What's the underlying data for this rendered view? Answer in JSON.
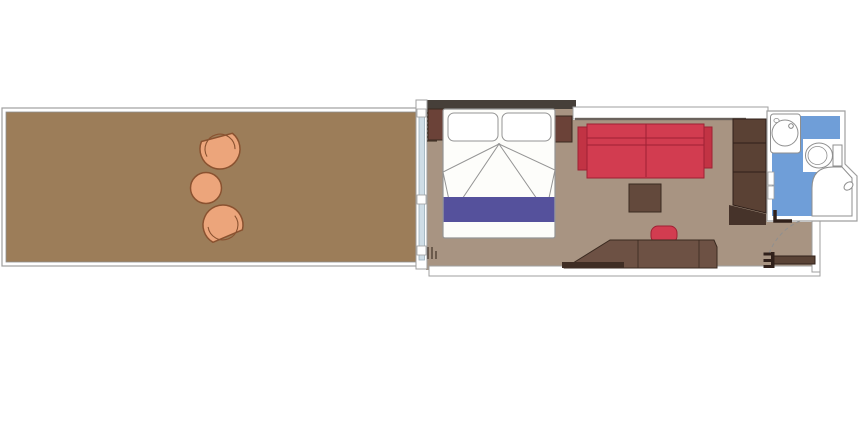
{
  "plan": {
    "kind": "stateroom-floor-plan",
    "rooms": [
      "balcony",
      "bedroom",
      "sitting-area",
      "bathroom",
      "entry-corridor"
    ],
    "palette": {
      "background": "#ffffff",
      "balcony_deck": "#9c7d59",
      "cabin_floor": "#a89482",
      "wall_dark": "#463f39",
      "wall_stroke": "#9f9f9f",
      "glass": "#cfdde6",
      "chair_tan": "#eca57b",
      "chair_stroke": "#8a5230",
      "wood_dark": "#5a4134",
      "wood_mid": "#6d5144",
      "wood_stroke": "#30201a",
      "sofa_red": "#d23c50",
      "sofa_red_dark": "#9e2133",
      "bed_runner_purple": "#55519c",
      "bathroom_blue": "#6f9ed8",
      "fixture_white": "#ffffff",
      "fixture_stroke": "#8f8f8f"
    },
    "viewbox": "0 0 866 426",
    "elements": [
      {
        "name": "balcony-frame",
        "type": "rect",
        "attrs": {
          "x": 2,
          "y": 108,
          "width": 423,
          "height": 158,
          "fill": "#ffffff",
          "stroke": "#9f9f9f",
          "stroke-width": 1.2
        }
      },
      {
        "name": "balcony-deck",
        "type": "rect",
        "attrs": {
          "x": 6,
          "y": 112,
          "width": 415,
          "height": 150,
          "fill": "#9c7d59",
          "stroke": "#8f8f8f",
          "stroke-width": 0.8
        }
      },
      {
        "name": "lounge-chair-top-body",
        "type": "path",
        "attrs": {
          "d": "M -16 -12 A 20 20 0 1 0 16 -12 Z",
          "transform": "translate(220,149) rotate(-15)",
          "fill": "#eca57b",
          "stroke": "#8a5230",
          "stroke-width": 1.5
        }
      },
      {
        "name": "lounge-chair-top-rim",
        "type": "path",
        "attrs": {
          "d": "M -14.5 4 A 15 15 0 1 1 14.5 4",
          "transform": "translate(220,149) rotate(-15)",
          "fill": "none",
          "stroke": "#8a5230",
          "stroke-width": 1.1
        }
      },
      {
        "name": "lounge-chair-bottom-body",
        "type": "path",
        "attrs": {
          "d": "M -16 -12 A 20 20 0 1 0 16 -12 Z",
          "transform": "translate(223,225) rotate(157)",
          "fill": "#eca57b",
          "stroke": "#8a5230",
          "stroke-width": 1.5
        }
      },
      {
        "name": "lounge-chair-bottom-rim",
        "type": "path",
        "attrs": {
          "d": "M -14.5 4 A 15 15 0 1 1 14.5 4",
          "transform": "translate(223,225) rotate(157)",
          "fill": "none",
          "stroke": "#8a5230",
          "stroke-width": 1.1
        }
      },
      {
        "name": "balcony-table",
        "type": "circle",
        "attrs": {
          "cx": 206,
          "cy": 188,
          "r": 15.5,
          "fill": "#eca57b",
          "stroke": "#8a5230",
          "stroke-width": 1.5
        }
      },
      {
        "name": "cabin-floor",
        "type": "polygon",
        "attrs": {
          "points": "426,105 573,105 573,120 767,120 767,222 812,222 812,270 426,270",
          "fill": "#a89482"
        }
      },
      {
        "name": "bottom-wall",
        "type": "rect",
        "attrs": {
          "x": 429,
          "y": 266,
          "width": 391,
          "height": 10,
          "fill": "#ffffff",
          "stroke": "#9f9f9f",
          "stroke-width": 1
        }
      },
      {
        "name": "corridor-right-wall",
        "type": "rect",
        "attrs": {
          "x": 812,
          "y": 220,
          "width": 8,
          "height": 52,
          "fill": "#ffffff",
          "stroke": "#9f9f9f",
          "stroke-width": 1
        }
      },
      {
        "name": "bedroom-top-wall",
        "type": "rect",
        "attrs": {
          "x": 416,
          "y": 100,
          "width": 160,
          "height": 9,
          "fill": "#463f39"
        }
      },
      {
        "name": "sitting-area-top-wall",
        "type": "rect",
        "attrs": {
          "x": 573,
          "y": 107,
          "width": 195,
          "height": 12,
          "fill": "#ffffff",
          "stroke": "#9f9f9f",
          "stroke-width": 1
        }
      },
      {
        "name": "sitting-area-top-wall-line",
        "type": "rect",
        "attrs": {
          "x": 575,
          "y": 117.8,
          "width": 171,
          "height": 2.4,
          "fill": "#6a625c"
        }
      },
      {
        "name": "window-wall",
        "type": "rect",
        "attrs": {
          "x": 416,
          "y": 100,
          "width": 11,
          "height": 169,
          "fill": "#ffffff",
          "stroke": "#9f9f9f",
          "stroke-width": 1
        }
      },
      {
        "name": "window-glass",
        "type": "rect",
        "attrs": {
          "x": 419,
          "y": 112,
          "width": 5.5,
          "height": 148,
          "fill": "#cfdde6",
          "stroke": "#9cb0bc",
          "stroke-width": 0.8
        }
      },
      {
        "name": "window-mullion-top",
        "type": "rect",
        "attrs": {
          "x": 417,
          "y": 109,
          "width": 9,
          "height": 8,
          "fill": "#ffffff",
          "stroke": "#9f9f9f",
          "stroke-width": 0.8
        }
      },
      {
        "name": "window-mullion-middle",
        "type": "rect",
        "attrs": {
          "x": 417,
          "y": 195,
          "width": 9,
          "height": 9,
          "fill": "#ffffff",
          "stroke": "#9f9f9f",
          "stroke-width": 0.8
        }
      },
      {
        "name": "window-mullion-bottom",
        "type": "rect",
        "attrs": {
          "x": 417,
          "y": 246,
          "width": 9,
          "height": 9,
          "fill": "#ffffff",
          "stroke": "#9f9f9f",
          "stroke-width": 0.8
        }
      },
      {
        "name": "curtain-top-hatch",
        "type": "path",
        "attrs": {
          "d": "M427,113 h10 M427,117 h10 M427,121 h10 M427,125 h10 M427,129 h10 M427,133 h10 M427,137 h10 M427,141 h10",
          "fill": "none",
          "stroke": "#4a3a2e",
          "stroke-width": 1.3
        }
      },
      {
        "name": "curtain-bottom-hatch",
        "type": "path",
        "attrs": {
          "d": "M428,247 v12 M432,247 v12 M436,251 v8",
          "fill": "none",
          "stroke": "#4a3a2e",
          "stroke-width": 1.3
        }
      },
      {
        "name": "nightstand-left",
        "type": "rect",
        "attrs": {
          "x": 428,
          "y": 109,
          "width": 22,
          "height": 31,
          "fill": "#6b4238",
          "stroke": "#3a2a20",
          "stroke-width": 1
        }
      },
      {
        "name": "nightstand-right",
        "type": "rect",
        "attrs": {
          "x": 553,
          "y": 116,
          "width": 19,
          "height": 26,
          "fill": "#6b4238",
          "stroke": "#3a2a20",
          "stroke-width": 1
        }
      },
      {
        "name": "bed",
        "type": "rect",
        "attrs": {
          "x": 443,
          "y": 109,
          "width": 112,
          "height": 129,
          "rx": 2,
          "fill": "#fdfdfa",
          "stroke": "#949494",
          "stroke-width": 1.2
        }
      },
      {
        "name": "pillow-left",
        "type": "rect",
        "attrs": {
          "x": 448,
          "y": 113,
          "width": 50,
          "height": 28,
          "rx": 6,
          "fill": "#ffffff",
          "stroke": "#949494",
          "stroke-width": 1
        }
      },
      {
        "name": "pillow-right",
        "type": "rect",
        "attrs": {
          "x": 502,
          "y": 113,
          "width": 49,
          "height": 28,
          "rx": 6,
          "fill": "#ffffff",
          "stroke": "#949494",
          "stroke-width": 1
        }
      },
      {
        "name": "duvet-fold-left",
        "type": "polygon",
        "attrs": {
          "points": "499,144 443,172 452,214",
          "fill": "#fdfdfa",
          "stroke": "#949494",
          "stroke-width": 1
        }
      },
      {
        "name": "duvet-fold-right",
        "type": "polygon",
        "attrs": {
          "points": "499,144 555,170 546,212",
          "fill": "#fdfdfa",
          "stroke": "#949494",
          "stroke-width": 1
        }
      },
      {
        "name": "bed-runner",
        "type": "rect",
        "attrs": {
          "x": 443.6,
          "y": 197,
          "width": 110.8,
          "height": 25,
          "fill": "#55519c"
        }
      },
      {
        "name": "sofa-armrest-left",
        "type": "rect",
        "attrs": {
          "x": 578,
          "y": 127,
          "width": 11,
          "height": 43,
          "fill": "#c23344",
          "stroke": "#9e2133",
          "stroke-width": 1
        }
      },
      {
        "name": "sofa-armrest-right",
        "type": "rect",
        "attrs": {
          "x": 703,
          "y": 127,
          "width": 9,
          "height": 41,
          "fill": "#c23344",
          "stroke": "#9e2133",
          "stroke-width": 1
        }
      },
      {
        "name": "sofa-body",
        "type": "rect",
        "attrs": {
          "x": 587,
          "y": 124,
          "width": 117,
          "height": 54,
          "fill": "#d23c50",
          "stroke": "#9e2133",
          "stroke-width": 1
        }
      },
      {
        "name": "sofa-back-line-1",
        "type": "line",
        "attrs": {
          "x1": 587,
          "y1": 138,
          "x2": 704,
          "y2": 138,
          "stroke": "#9e2133",
          "stroke-width": 1
        }
      },
      {
        "name": "sofa-back-line-2",
        "type": "line",
        "attrs": {
          "x1": 587,
          "y1": 145,
          "x2": 704,
          "y2": 145,
          "stroke": "#9e2133",
          "stroke-width": 1
        }
      },
      {
        "name": "sofa-cushion-divider",
        "type": "line",
        "attrs": {
          "x1": 646,
          "y1": 124,
          "x2": 646,
          "y2": 177,
          "stroke": "#9e2133",
          "stroke-width": 1
        }
      },
      {
        "name": "coffee-table",
        "type": "rect",
        "attrs": {
          "x": 629,
          "y": 184,
          "width": 32,
          "height": 28,
          "fill": "#63493c",
          "stroke": "#3a2a20",
          "stroke-width": 1
        }
      },
      {
        "name": "desk-stool",
        "type": "rect",
        "attrs": {
          "x": 651,
          "y": 226,
          "width": 26,
          "height": 17,
          "rx": 7,
          "fill": "#d23c50",
          "stroke": "#9e2133",
          "stroke-width": 1
        }
      },
      {
        "name": "desk",
        "type": "polygon",
        "attrs": {
          "points": "565,268 610,240 714,240 717,247 717,268",
          "fill": "#6d5144",
          "stroke": "#3a2a20",
          "stroke-width": 1
        }
      },
      {
        "name": "desk-divider-1",
        "type": "line",
        "attrs": {
          "x1": 638,
          "y1": 240,
          "x2": 638,
          "y2": 268,
          "stroke": "#3a2a20",
          "stroke-width": 0.8
        }
      },
      {
        "name": "desk-divider-2",
        "type": "line",
        "attrs": {
          "x1": 699,
          "y1": 240,
          "x2": 699,
          "y2": 268,
          "stroke": "#3a2a20",
          "stroke-width": 0.8
        }
      },
      {
        "name": "desk-ledge",
        "type": "rect",
        "attrs": {
          "x": 562,
          "y": 262,
          "width": 62,
          "height": 6,
          "fill": "#3f2d24"
        }
      },
      {
        "name": "wardrobe",
        "type": "polygon",
        "attrs": {
          "points": "733,119 766,119 766,213 733,205",
          "fill": "#5a4134",
          "stroke": "#30201a",
          "stroke-width": 1
        }
      },
      {
        "name": "wardrobe-divider-1",
        "type": "line",
        "attrs": {
          "x1": 733,
          "y1": 143,
          "x2": 766,
          "y2": 143,
          "stroke": "#30201a",
          "stroke-width": 1
        }
      },
      {
        "name": "wardrobe-divider-2",
        "type": "line",
        "attrs": {
          "x1": 733,
          "y1": 172,
          "x2": 766,
          "y2": 172,
          "stroke": "#30201a",
          "stroke-width": 1
        }
      },
      {
        "name": "wardrobe-base-wedge",
        "type": "polygon",
        "attrs": {
          "points": "729,205 766,214 766,225 729,225",
          "fill": "#46332a"
        }
      },
      {
        "name": "bathroom-walls",
        "type": "path",
        "attrs": {
          "d": "M767,111 H845 V164 L857,176 V221 H767 Z",
          "fill": "#ffffff",
          "stroke": "#9f9f9f",
          "stroke-width": 1.2
        }
      },
      {
        "name": "bathroom-floor",
        "type": "polygon",
        "attrs": {
          "points": "772,116 840,116 840,166 852,178 852,216 772,216",
          "fill": "#6f9ed8"
        }
      },
      {
        "name": "sink-counter",
        "type": "rect",
        "attrs": {
          "x": 770.5,
          "y": 114,
          "width": 30,
          "height": 39,
          "rx": 3,
          "fill": "#ffffff",
          "stroke": "#8f8f8f",
          "stroke-width": 1
        }
      },
      {
        "name": "sink-basin",
        "type": "circle",
        "attrs": {
          "cx": 785,
          "cy": 133,
          "r": 13,
          "fill": "#ffffff",
          "stroke": "#8f8f8f",
          "stroke-width": 1
        }
      },
      {
        "name": "sink-faucet",
        "type": "circle",
        "attrs": {
          "cx": 791,
          "cy": 126,
          "r": 2.3,
          "fill": "#ffffff",
          "stroke": "#777777",
          "stroke-width": 0.9
        }
      },
      {
        "name": "sink-soap-dish",
        "type": "ellipse",
        "attrs": {
          "cx": 776.5,
          "cy": 120.5,
          "rx": 2.6,
          "ry": 2,
          "fill": "#ffffff",
          "stroke": "#8f8f8f",
          "stroke-width": 0.8
        }
      },
      {
        "name": "toilet-alcove",
        "type": "rect",
        "attrs": {
          "x": 803,
          "y": 139,
          "width": 37,
          "height": 33,
          "fill": "#ffffff"
        }
      },
      {
        "name": "toilet-tank",
        "type": "rect",
        "attrs": {
          "x": 833,
          "y": 145,
          "width": 9,
          "height": 21,
          "fill": "#ffffff",
          "stroke": "#8f8f8f",
          "stroke-width": 1
        }
      },
      {
        "name": "toilet-bowl",
        "type": "ellipse",
        "attrs": {
          "cx": 819,
          "cy": 155.5,
          "rx": 13.5,
          "ry": 12.5,
          "fill": "#ffffff",
          "stroke": "#8f8f8f",
          "stroke-width": 1
        }
      },
      {
        "name": "toilet-seat-line",
        "type": "ellipse",
        "attrs": {
          "cx": 817.5,
          "cy": 155.5,
          "rx": 9.5,
          "ry": 9,
          "fill": "none",
          "stroke": "#8f8f8f",
          "stroke-width": 0.8
        }
      },
      {
        "name": "shower-pan",
        "type": "path",
        "attrs": {
          "d": "M812,216 V188 Q812,167 833,167 H842 L852,178 V216 Z",
          "fill": "#ffffff",
          "stroke": "#8f8f8f",
          "stroke-width": 1
        }
      },
      {
        "name": "shower-fixture",
        "type": "ellipse",
        "attrs": {
          "cx": 848.5,
          "cy": 186,
          "rx": 5,
          "ry": 3.5,
          "transform": "rotate(-40 848.5 186)",
          "fill": "#ffffff",
          "stroke": "#8f8f8f",
          "stroke-width": 1
        }
      },
      {
        "name": "bathroom-shelf-1",
        "type": "rect",
        "attrs": {
          "x": 768,
          "y": 172,
          "width": 6,
          "height": 13,
          "fill": "#ffffff",
          "stroke": "#9f9f9f",
          "stroke-width": 0.8
        }
      },
      {
        "name": "bathroom-shelf-2",
        "type": "rect",
        "attrs": {
          "x": 768,
          "y": 186,
          "width": 6,
          "height": 13,
          "fill": "#ffffff",
          "stroke": "#9f9f9f",
          "stroke-width": 0.8
        }
      },
      {
        "name": "bathroom-door-leaf",
        "type": "path",
        "attrs": {
          "d": "M775,210 V221 H792",
          "fill": "none",
          "stroke": "#30201a",
          "stroke-width": 3.5
        }
      },
      {
        "name": "entry-door-swing-arc",
        "type": "path",
        "attrs": {
          "d": "M800,221 Q777,231 768,256",
          "fill": "none",
          "stroke": "#8f8f8f",
          "stroke-width": 1,
          "stroke-dasharray": "4 3"
        }
      },
      {
        "name": "entry-door",
        "type": "rect",
        "attrs": {
          "x": 772,
          "y": 256,
          "width": 43,
          "height": 8,
          "fill": "#5a4336",
          "stroke": "#30201a",
          "stroke-width": 1
        }
      },
      {
        "name": "entry-door-hinge-bar",
        "type": "rect",
        "attrs": {
          "x": 771,
          "y": 252,
          "width": 3.5,
          "height": 16,
          "fill": "#30201a"
        }
      },
      {
        "name": "entry-door-hinge-prong-top",
        "type": "rect",
        "attrs": {
          "x": 763.5,
          "y": 252.5,
          "width": 8.5,
          "height": 3,
          "fill": "#30201a"
        }
      },
      {
        "name": "entry-door-hinge-prong-mid",
        "type": "rect",
        "attrs": {
          "x": 763.5,
          "y": 259,
          "width": 8.5,
          "height": 3,
          "fill": "#30201a"
        }
      },
      {
        "name": "entry-door-hinge-prong-bottom",
        "type": "rect",
        "attrs": {
          "x": 763.5,
          "y": 265,
          "width": 8.5,
          "height": 3,
          "fill": "#30201a"
        }
      }
    ]
  }
}
